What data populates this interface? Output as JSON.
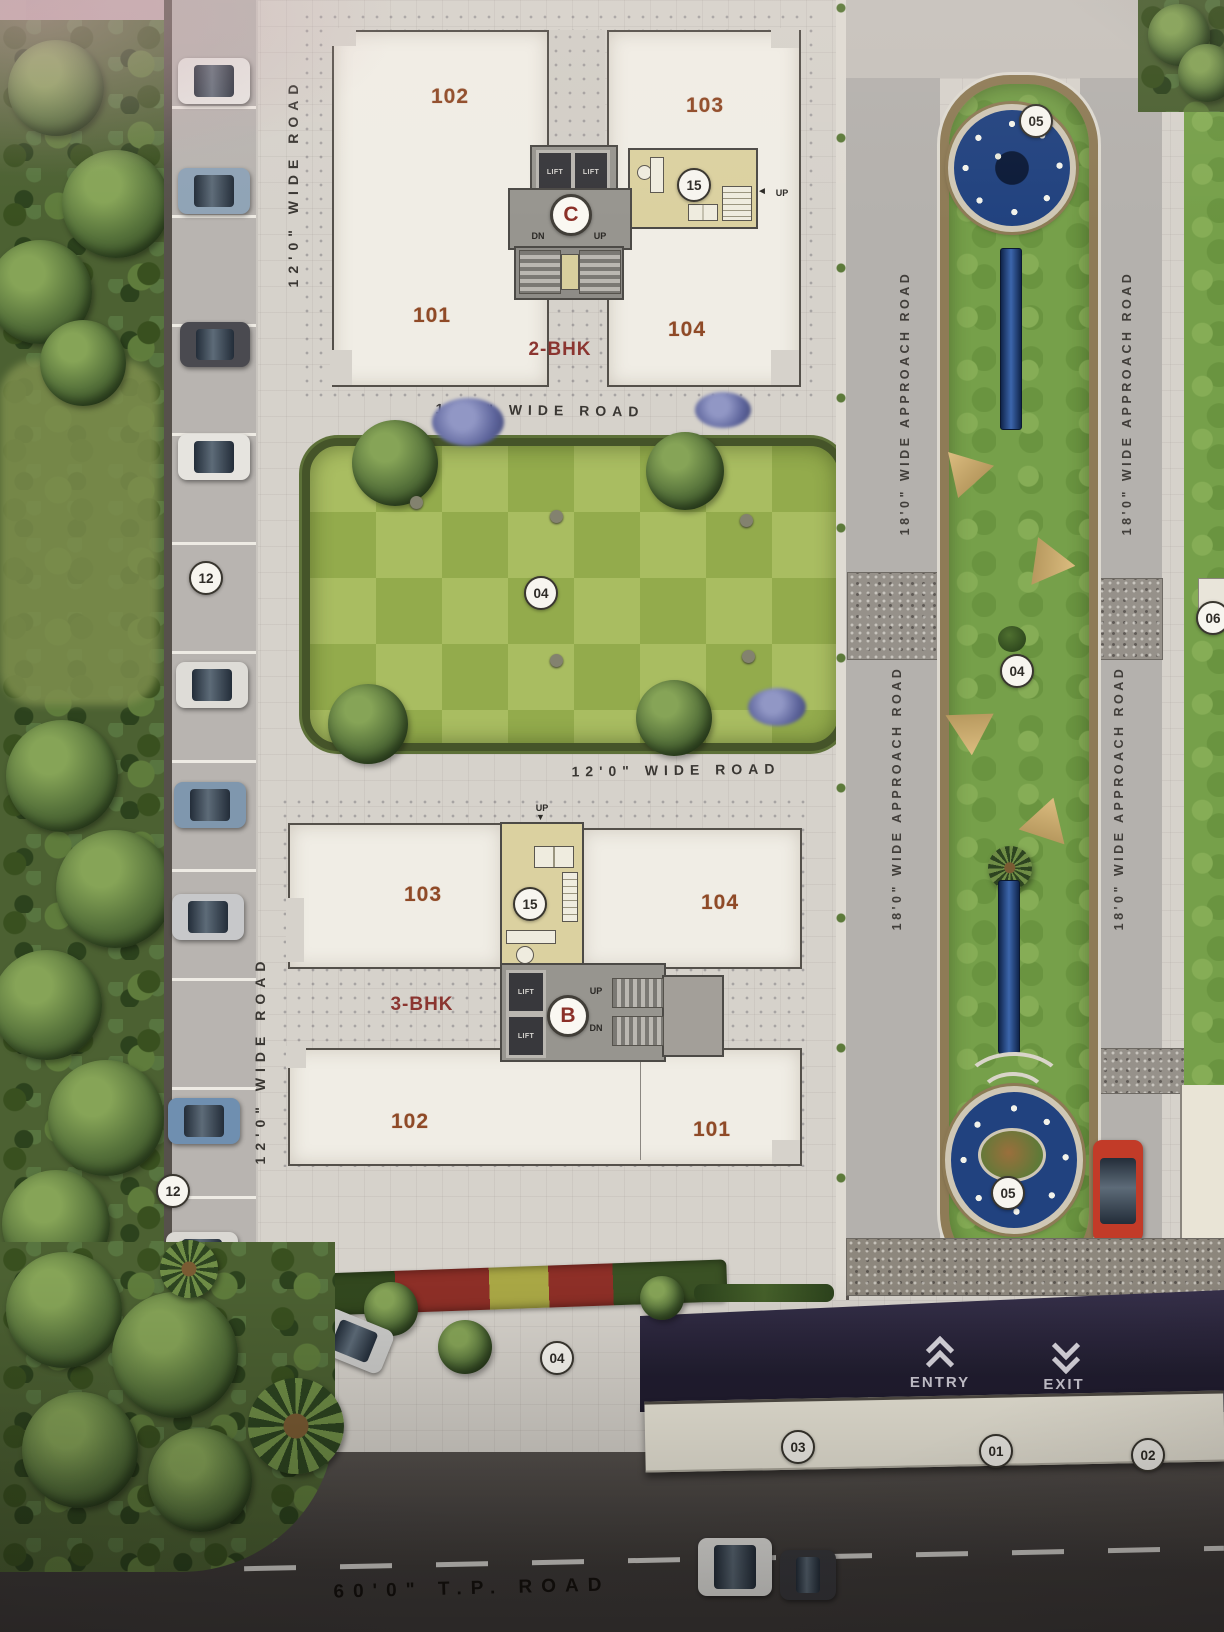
{
  "roads": {
    "wide_road_label": "12'0\" WIDE ROAD",
    "approach_road_label": "18'0\" WIDE APPROACH ROAD",
    "tp_road_label": "60'0\" T.P. ROAD"
  },
  "building_c": {
    "block_letter": "C",
    "type_label": "2-BHK",
    "unit_top_left": "102",
    "unit_top_right": "103",
    "unit_bottom_left": "101",
    "unit_bottom_right": "104",
    "lift_label": "LIFT",
    "stair_down": "DN",
    "stair_up": "UP",
    "entry_up": "UP",
    "flat_badge": "15"
  },
  "building_b": {
    "block_letter": "B",
    "type_label": "3-BHK",
    "unit_top_left": "103",
    "unit_top_right": "104",
    "unit_bottom_left": "102",
    "unit_bottom_right": "101",
    "lift_label": "LIFT",
    "stair_up": "UP",
    "stair_down": "DN",
    "entry_up": "UP",
    "flat_badge": "15"
  },
  "badges": {
    "parking": "12",
    "lawn_garden": "04",
    "median_lawn": "04",
    "entrance_garden": "04",
    "fountain_top": "05",
    "fountain_bottom": "05",
    "boundary_left": "03",
    "boundary_center": "01",
    "boundary_right": "02",
    "right_plot": "06"
  },
  "gate": {
    "entry_label": "ENTRY",
    "exit_label": "EXIT"
  },
  "icons": {
    "c_entry_arrow": "◄",
    "b_entry_arrow": "▼"
  },
  "colors": {
    "accent_unit": "#8f4a27",
    "accent_bhk": "#8b3530",
    "lawn_light": "#a9bd61",
    "lawn_dark": "#93ab4c",
    "fountain_blue": "#21427f",
    "entry_band": "#2c2838"
  }
}
